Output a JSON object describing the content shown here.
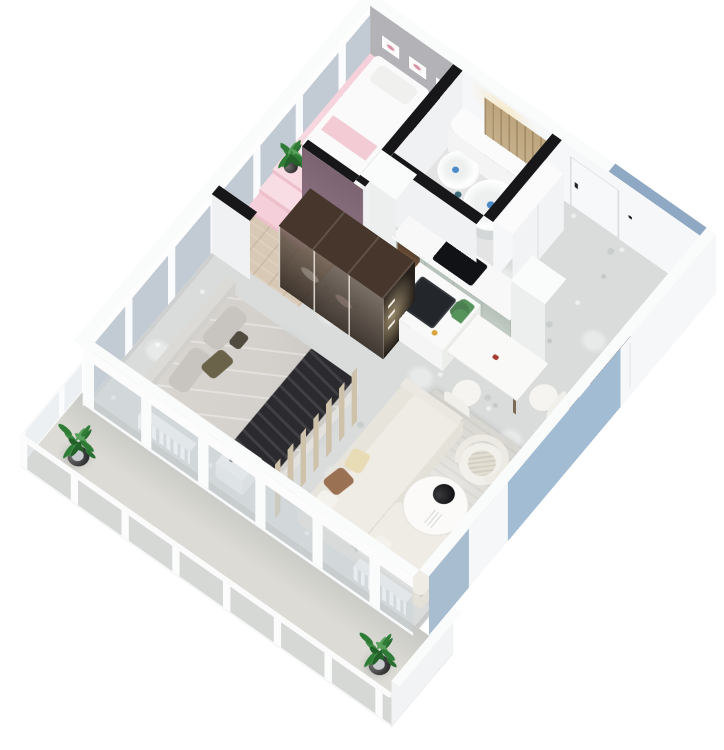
{
  "scene": {
    "kind": "3d-isometric-apartment-floor-plan-render",
    "background": "#ffffff",
    "view": "bird's-eye axonometric, unit rotated with balcony at lower left",
    "visible_text": "none"
  },
  "palette": {
    "bg": "#ffffff",
    "wall-top": "#fafbfb",
    "wall-face": "#f0f1f3",
    "wall-face-bright": "#f6f7f8",
    "cut-top": "#17171a",
    "marble": "#d9dcdb",
    "wood": "#d8c9b6",
    "pink": "#f5cfd9",
    "pink-bright": "#f9dde4",
    "pink-riser": "#eec0cc",
    "mauve": "#8c7181",
    "gray-wall": "#b3b2b6",
    "sage": "#c4cec6",
    "blue": "#a2bcd4",
    "blue-soft": "#8fa9c4",
    "glass": "rgba(199,209,217,0.42)",
    "glass-pane": "#c2cad3",
    "slat": "#cfc2ab",
    "wood-dark": "#46362b",
    "bedding": "#d3d0cc",
    "pillow": "#c8c5c1",
    "olive": "#6b6349",
    "throw": "#2b2b2f",
    "sofa": "#efece5",
    "sofa-shade": "#e4e1d9",
    "caramel": "#9a7152",
    "cream": "#e8dcb6",
    "rug": "#d8d6d0",
    "green": "#2f7c36",
    "green-dark": "#226128",
    "teal": "#3c6b76",
    "ink": "#121214",
    "counter": "#f7f8f7",
    "bath-floor": "#e3e4e3",
    "balcony-floor": "#dcdbd5",
    "door-wood": "#c9b491"
  },
  "rooms": [
    {
      "name": "bedroom",
      "items": [
        "double-bed",
        "gray-bedding",
        "dark-throw-blanket",
        "olive-pillow",
        "headboard",
        "nightstand",
        "radiator",
        "slatted-wood-partition",
        "window-wall"
      ]
    },
    {
      "name": "living-room",
      "items": [
        "l-shaped-white-sofa",
        "caramel-pillow",
        "cream-pillow",
        "round-coffee-table",
        "black-bowl",
        "white-armchair",
        "area-rug",
        "tv-console",
        "tv",
        "radiator"
      ]
    },
    {
      "name": "kitchen",
      "items": [
        "sage-cabinet-run",
        "induction-cooktop",
        "wood-coffee-niche",
        "tall-cabinets",
        "island-with-black-sink",
        "faucet",
        "dining-table",
        "white-chair",
        "white-chair",
        "flower-sprig"
      ]
    },
    {
      "name": "pink-room",
      "items": [
        "raised-pink-platform",
        "three-steps",
        "white-platform-bed",
        "pink-throw",
        "three-wall-frames",
        "gray-accent-wall",
        "mauve-accent-wall",
        "wall-tv",
        "potted-plant",
        "white-bench",
        "wood-tray"
      ]
    },
    {
      "name": "bathroom",
      "items": [
        "round-tub",
        "round-basin",
        "curved-counter",
        "cove-light",
        "wood-slat-sliding-door",
        "dark-vanity",
        "towels",
        "blue-drain-dots"
      ]
    },
    {
      "name": "entry-hall",
      "items": [
        "white-front-door",
        "door-handle",
        "tall-white-cabinet",
        "marble-floor"
      ]
    },
    {
      "name": "balcony",
      "items": [
        "glass-railing",
        "white-rail-posts",
        "potted-plant-north",
        "potted-plant-south",
        "white-privacy-wall",
        "deck-floor"
      ]
    },
    {
      "name": "wardrobe-hall",
      "items": [
        "glass-front-wardrobe",
        "dark-wood-top",
        "lighted-shelves",
        "wood-floor"
      ]
    }
  ],
  "accents": {
    "exterior-blue-panels": 3,
    "black-wall-cut-tops": true
  }
}
